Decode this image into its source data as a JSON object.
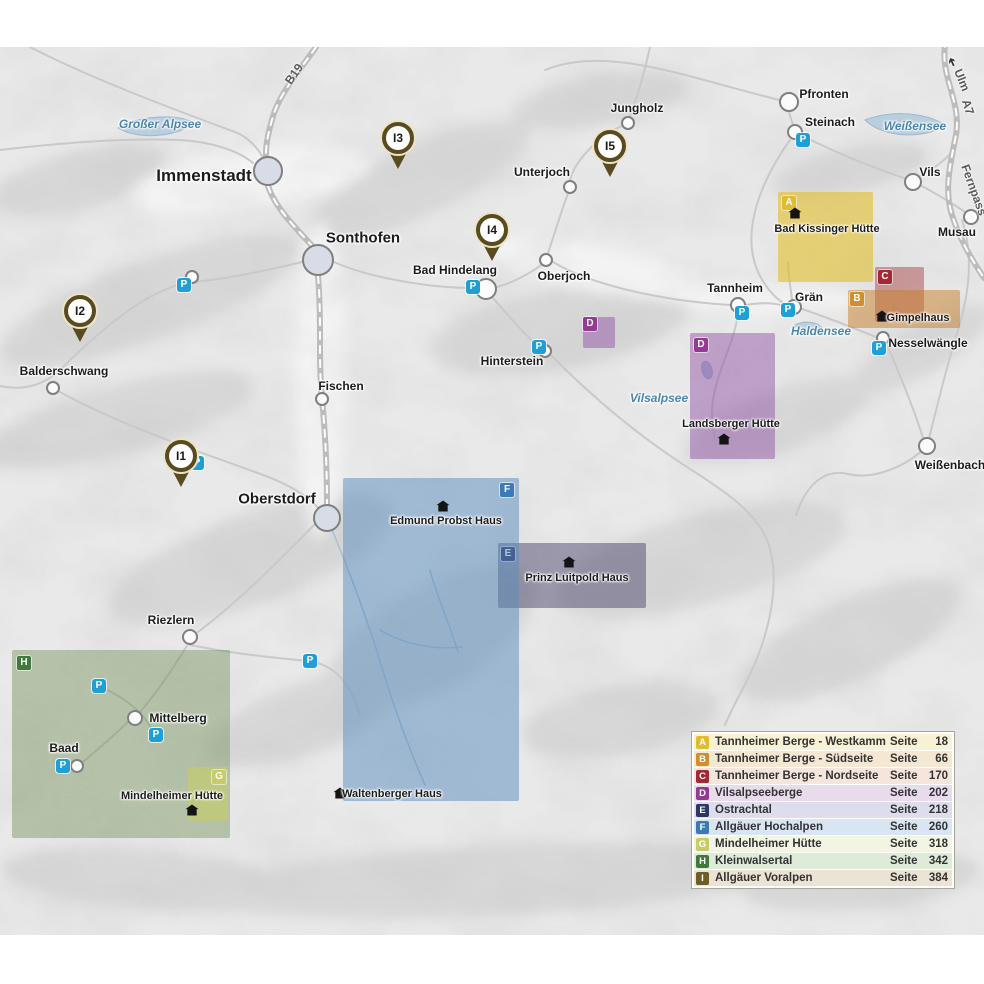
{
  "legend": {
    "page_word": "Seite",
    "items": [
      {
        "letter": "A",
        "label": "Tannheimer Berge - Westkamm",
        "page": "18",
        "badge": "#e0bc2e",
        "row": "#f8f1d6"
      },
      {
        "letter": "B",
        "label": "Tannheimer Berge - Südseite",
        "page": "66",
        "badge": "#cf8f2f",
        "row": "#f5e8d2"
      },
      {
        "letter": "C",
        "label": "Tannheimer Berge - Nordseite",
        "page": "170",
        "badge": "#a32833",
        "row": "#f4e6dd"
      },
      {
        "letter": "D",
        "label": "Vilsalpseeberge",
        "page": "202",
        "badge": "#943a94",
        "row": "#e8dbec"
      },
      {
        "letter": "E",
        "label": "Ostrachtal",
        "page": "218",
        "badge": "#2c3766",
        "row": "#dddded"
      },
      {
        "letter": "F",
        "label": "Allgäuer Hochalpen",
        "page": "260",
        "badge": "#3b79b7",
        "row": "#d9e5f3"
      },
      {
        "letter": "G",
        "label": "Mindelheimer Hütte",
        "page": "318",
        "badge": "#c6cc6a",
        "row": "#f3f5e3"
      },
      {
        "letter": "H",
        "label": "Kleinwalsertal",
        "page": "342",
        "badge": "#3f7a3a",
        "row": "#deebd9"
      },
      {
        "letter": "I",
        "label": "Allgäuer Voralpen",
        "page": "384",
        "badge": "#6d5d28",
        "row": "#ebe3d3"
      }
    ]
  },
  "map": {
    "parking_letter": "P",
    "towns": [
      {
        "name": "Immenstadt",
        "lx": 204,
        "ly": 176,
        "fs": 17,
        "cx": 268,
        "cy": 171,
        "r": 15,
        "big": true
      },
      {
        "name": "Sonthofen",
        "lx": 363,
        "ly": 238,
        "fs": 15,
        "cx": 318,
        "cy": 260,
        "r": 16,
        "big": true
      },
      {
        "name": "Oberstdorf",
        "lx": 277,
        "ly": 499,
        "fs": 15,
        "cx": 327,
        "cy": 518,
        "r": 14,
        "big": true
      },
      {
        "name": "Fischen",
        "lx": 341,
        "ly": 386,
        "fs": 12,
        "cx": 322,
        "cy": 399,
        "r": 7
      },
      {
        "name": "Balderschwang",
        "lx": 64,
        "ly": 371,
        "fs": 12,
        "cx": 53,
        "cy": 388,
        "r": 7
      },
      {
        "name": "Riezlern",
        "lx": 171,
        "ly": 620,
        "fs": 12,
        "cx": 190,
        "cy": 637,
        "r": 8
      },
      {
        "name": "Mittelberg",
        "lx": 178,
        "ly": 718,
        "fs": 12,
        "cx": 135,
        "cy": 718,
        "r": 8
      },
      {
        "name": "Baad",
        "lx": 64,
        "ly": 748,
        "fs": 12,
        "cx": 77,
        "cy": 766,
        "r": 7,
        "p": [
          63,
          766
        ]
      },
      {
        "name": "",
        "lx": 0,
        "ly": 0,
        "fs": 12,
        "cx": 192,
        "cy": 277,
        "r": 7,
        "p": [
          184,
          285
        ]
      },
      {
        "name": "Bad Hindelang",
        "lx": 455,
        "ly": 270,
        "fs": 12,
        "cx": 486,
        "cy": 289,
        "r": 11,
        "p": [
          473,
          287
        ]
      },
      {
        "name": "Oberjoch",
        "lx": 564,
        "ly": 276,
        "fs": 12,
        "cx": 546,
        "cy": 260,
        "r": 7
      },
      {
        "name": "Unterjoch",
        "lx": 542,
        "ly": 172,
        "fs": 12,
        "cx": 570,
        "cy": 187,
        "r": 7
      },
      {
        "name": "Jungholz",
        "lx": 637,
        "ly": 108,
        "fs": 12,
        "cx": 628,
        "cy": 123,
        "r": 7
      },
      {
        "name": "Hinterstein",
        "lx": 512,
        "ly": 361,
        "fs": 12,
        "cx": 545,
        "cy": 351,
        "r": 7,
        "p": [
          539,
          347
        ]
      },
      {
        "name": "Pfronten",
        "lx": 824,
        "ly": 94,
        "fs": 12,
        "cx": 789,
        "cy": 102,
        "r": 10
      },
      {
        "name": "Steinach",
        "lx": 830,
        "ly": 122,
        "fs": 12,
        "cx": 795,
        "cy": 132,
        "r": 8,
        "p": [
          803,
          140
        ]
      },
      {
        "name": "Vils",
        "lx": 930,
        "ly": 172,
        "fs": 12,
        "cx": 913,
        "cy": 182,
        "r": 9
      },
      {
        "name": "Musau",
        "lx": 957,
        "ly": 232,
        "fs": 12,
        "cx": 971,
        "cy": 217,
        "r": 8
      },
      {
        "name": "Tannheim",
        "lx": 735,
        "ly": 288,
        "fs": 12,
        "cx": 738,
        "cy": 305,
        "r": 8,
        "p": [
          742,
          313
        ]
      },
      {
        "name": "Grän",
        "lx": 809,
        "ly": 297,
        "fs": 12,
        "cx": 794,
        "cy": 307,
        "r": 8,
        "p": [
          788,
          310
        ]
      },
      {
        "name": "Nesselwängle",
        "lx": 928,
        "ly": 343,
        "fs": 12,
        "cx": 883,
        "cy": 338,
        "r": 7,
        "p": [
          879,
          348
        ]
      },
      {
        "name": "Weißenbach",
        "lx": 950,
        "ly": 465,
        "fs": 12,
        "cx": 927,
        "cy": 446,
        "r": 9
      }
    ],
    "pins": [
      {
        "label": "I1",
        "x": 181,
        "y": 455
      },
      {
        "label": "I2",
        "x": 80,
        "y": 310
      },
      {
        "label": "I3",
        "x": 398,
        "y": 137
      },
      {
        "label": "I4",
        "x": 492,
        "y": 229
      },
      {
        "label": "I5",
        "x": 610,
        "y": 145
      }
    ],
    "parkings": [
      {
        "x": 197,
        "y": 463
      },
      {
        "x": 99,
        "y": 686
      },
      {
        "x": 156,
        "y": 735
      },
      {
        "x": 310,
        "y": 661
      }
    ],
    "lakes": [
      {
        "name": "Großer Alpsee",
        "x": 160,
        "y": 124
      },
      {
        "name": "Weißensee",
        "x": 915,
        "y": 126
      },
      {
        "name": "Haldensee",
        "x": 821,
        "y": 331
      },
      {
        "name": "Vilsalpsee",
        "x": 659,
        "y": 398
      }
    ],
    "road_labels": [
      {
        "name": "B19",
        "x": 294,
        "y": 74,
        "rot": -55
      },
      {
        "name": "A7",
        "x": 968,
        "y": 107,
        "rot": 72
      },
      {
        "name": "Ulm",
        "x": 962,
        "y": 80,
        "rot": 68
      },
      {
        "name": "Fernpass",
        "x": 974,
        "y": 190,
        "rot": 70
      }
    ],
    "ulm_arrow": "➔",
    "regions": [
      {
        "letter": "H",
        "x": 12,
        "y": 650,
        "w": 218,
        "h": 188,
        "fill": "rgba(110,140,80,0.42)",
        "badge": "#3f7a3a",
        "bx": 17,
        "by": 656
      },
      {
        "letter": "A",
        "x": 778,
        "y": 192,
        "w": 95,
        "h": 90,
        "fill": "rgba(225,190,40,0.6)",
        "badge": "#e0bc2e",
        "bx": 782,
        "by": 196
      },
      {
        "letter": "C",
        "x": 875,
        "y": 267,
        "w": 49,
        "h": 55,
        "fill": "rgba(165,55,55,0.45)",
        "badge": "#a32833",
        "bx": 878,
        "by": 270
      },
      {
        "letter": "B",
        "x": 848,
        "y": 290,
        "w": 112,
        "h": 38,
        "fill": "rgba(200,125,40,0.5)",
        "badge": "#cf8f2f",
        "bx": 850,
        "by": 292
      },
      {
        "letter": "D",
        "x": 583,
        "y": 317,
        "w": 32,
        "h": 31,
        "fill": "rgba(140,70,160,0.45)",
        "badge": "#943a94",
        "bx": 583,
        "by": 317
      },
      {
        "letter": "D",
        "x": 690,
        "y": 333,
        "w": 85,
        "h": 126,
        "fill": "rgba(140,70,160,0.45)",
        "badge": "#943a94",
        "bx": 694,
        "by": 338
      },
      {
        "letter": "E",
        "x": 498,
        "y": 543,
        "w": 148,
        "h": 65,
        "fill": "rgba(60,55,95,0.45)",
        "badge": "#2c3766",
        "bx": 501,
        "by": 547
      },
      {
        "letter": "F",
        "x": 343,
        "y": 478,
        "w": 176,
        "h": 323,
        "fill": "rgba(90,140,190,0.5)",
        "badge": "#3b79b7",
        "bx": 500,
        "by": 483
      },
      {
        "letter": "G",
        "x": 188,
        "y": 767,
        "w": 40,
        "h": 54,
        "fill": "rgba(200,205,95,0.55)",
        "badge": "#c6cc6a",
        "bx": 212,
        "by": 770
      }
    ],
    "huts": [
      {
        "name": "Bad Kissinger Hütte",
        "ix": 795,
        "iy": 213,
        "lx": 827,
        "ly": 229
      },
      {
        "name": "Gimpelhaus",
        "ix": 882,
        "iy": 316,
        "lx": 918,
        "ly": 318
      },
      {
        "name": "Landsberger Hütte",
        "ix": 724,
        "iy": 439,
        "lx": 731,
        "ly": 424
      },
      {
        "name": "Prinz Luitpold Haus",
        "ix": 569,
        "iy": 562,
        "lx": 577,
        "ly": 578
      },
      {
        "name": "Edmund Probst Haus",
        "ix": 443,
        "iy": 506,
        "lx": 446,
        "ly": 521
      },
      {
        "name": "Waltenberger Haus",
        "ix": 340,
        "iy": 793,
        "lx": 392,
        "ly": 794
      },
      {
        "name": "Mindelheimer Hütte",
        "ix": 192,
        "iy": 810,
        "lx": 172,
        "ly": 796
      }
    ]
  }
}
